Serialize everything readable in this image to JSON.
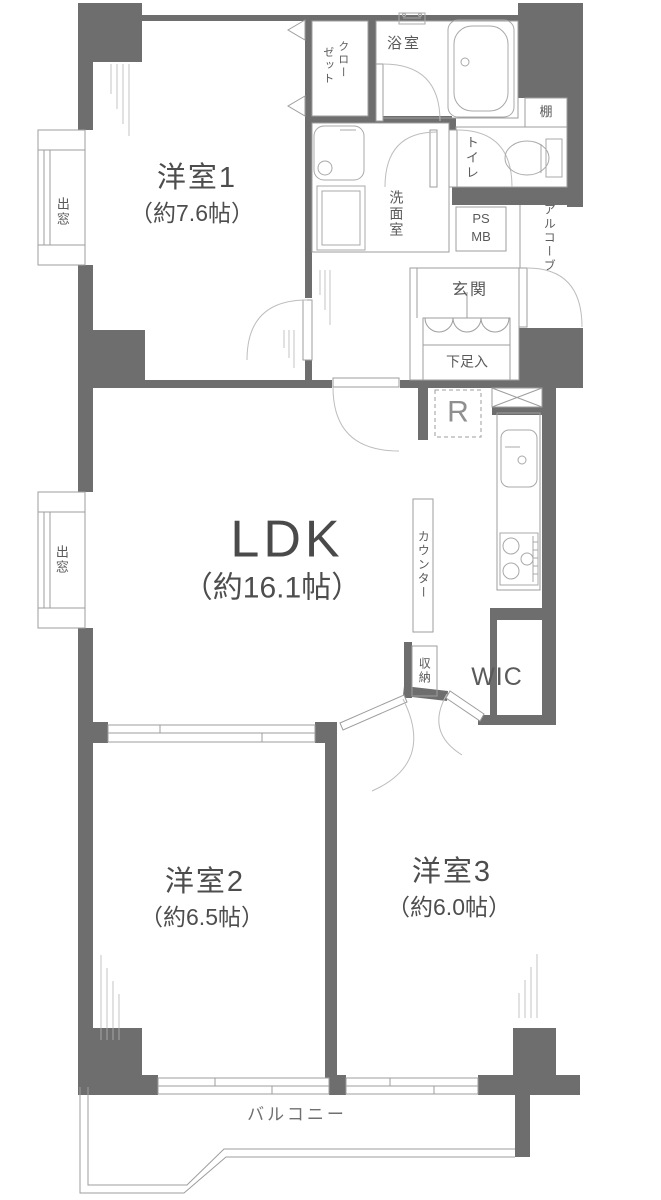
{
  "title": "マンション間取り図 3LDK",
  "colors": {
    "wall": "#6e6e6e",
    "line": "#9d9d9d",
    "arc": "#bdbdbd",
    "text": "#4d4d4d",
    "muted": "#8f8f8f"
  },
  "rooms": {
    "western1": {
      "name": "洋室1",
      "size": "（約7.6帖）"
    },
    "ldk": {
      "name": "LDK",
      "size": "（約16.1帖）"
    },
    "western2": {
      "name": "洋室2",
      "size": "（約6.5帖）"
    },
    "western3": {
      "name": "洋室3",
      "size": "（約6.0帖）"
    },
    "balcony": {
      "name": "バルコニー"
    },
    "bath": {
      "name": "浴室"
    },
    "washroom": {
      "name": "洗面室"
    },
    "toilet": {
      "name": "トイレ"
    },
    "closet": {
      "name": "クローゼット",
      "col_right": "クロー",
      "col_left": "ゼット"
    },
    "entrance": {
      "name": "玄関"
    },
    "shoe_cabinet": {
      "name": "下足入"
    },
    "shelf": {
      "name": "棚"
    },
    "pipe_space": {
      "line1": "PS",
      "line2": "MB"
    },
    "alcove": {
      "name": "アルコーブ"
    },
    "counter": {
      "name": "カウンター"
    },
    "storage": {
      "name": "収納"
    },
    "wic": {
      "name": "WIC"
    },
    "refrigerator": {
      "name": "R"
    },
    "bay_window_upper": {
      "name": "出窓"
    },
    "bay_window_lower": {
      "name": "出窓"
    }
  }
}
